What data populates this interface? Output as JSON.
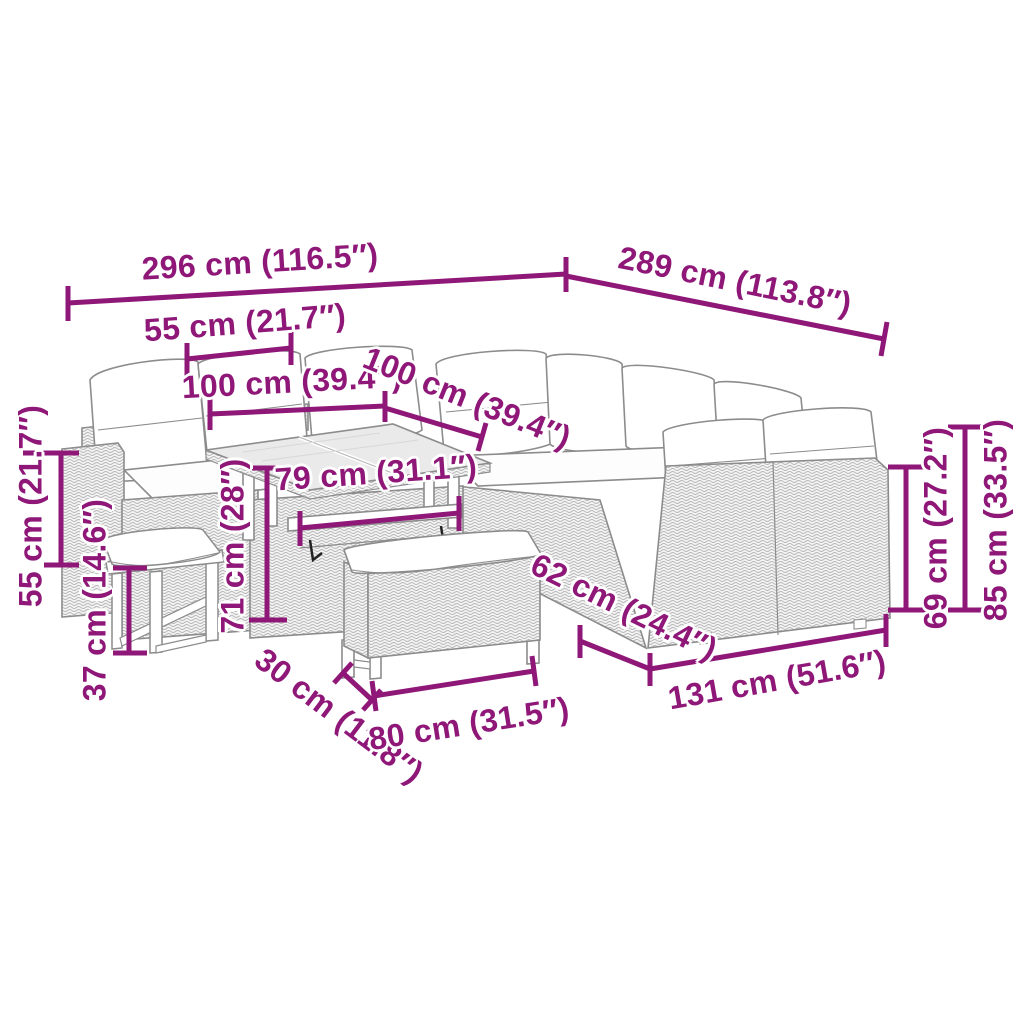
{
  "page": {
    "type": "product dimensions diagram",
    "product": "Poly rattan garden lounge set with sofas, adjustable table, stool and bench",
    "background": "#ffffff"
  },
  "colors": {
    "dimension_accent": "#8E1778",
    "line_art": "#8c8c8c",
    "rattan_fill": "#f4f4f4",
    "cushion": "#ffffff",
    "glass_top": "#eaeaea"
  },
  "dimensions": [
    {
      "id": "total-width-left",
      "cm": "296 cm",
      "inches": "116.5″",
      "text": "296 cm (116.5″)"
    },
    {
      "id": "total-width-right",
      "cm": "289 cm",
      "inches": "113.8″",
      "text": "289 cm (113.8″)"
    },
    {
      "id": "seat-width",
      "cm": "55 cm",
      "inches": "21.7″",
      "text": "55 cm (21.7″)"
    },
    {
      "id": "table-top-left",
      "cm": "100 cm",
      "inches": "39.4″",
      "text": "100 cm (39.4″)"
    },
    {
      "id": "table-top-right",
      "cm": "100 cm",
      "inches": "39.4″",
      "text": "100 cm (39.4″)"
    },
    {
      "id": "table-base-width",
      "cm": "79 cm",
      "inches": "31.1″",
      "text": "79 cm (31.1″)"
    },
    {
      "id": "table-height",
      "cm": "71 cm",
      "inches": "28″",
      "text": "71 cm (28″)"
    },
    {
      "id": "seat-height",
      "cm": "55 cm",
      "inches": "21.7″",
      "text": "55 cm (21.7″)"
    },
    {
      "id": "stool-height",
      "cm": "37 cm",
      "inches": "14.6″",
      "text": "37 cm (14.6″)"
    },
    {
      "id": "bench-depth",
      "cm": "30 cm",
      "inches": "11.8″",
      "text": "30 cm (11.8″)"
    },
    {
      "id": "bench-length",
      "cm": "80 cm",
      "inches": "31.5″",
      "text": "80 cm (31.5″)"
    },
    {
      "id": "sofa-depth",
      "cm": "62 cm",
      "inches": "24.4″",
      "text": "62 cm (24.4″)"
    },
    {
      "id": "right-sofa-length",
      "cm": "131 cm",
      "inches": "51.6″",
      "text": "131 cm (51.6″)"
    },
    {
      "id": "back-height",
      "cm": "69 cm",
      "inches": "27.2″",
      "text": "69 cm (27.2″)"
    },
    {
      "id": "total-height",
      "cm": "85 cm",
      "inches": "33.5″",
      "text": "85 cm (33.5″)"
    }
  ]
}
